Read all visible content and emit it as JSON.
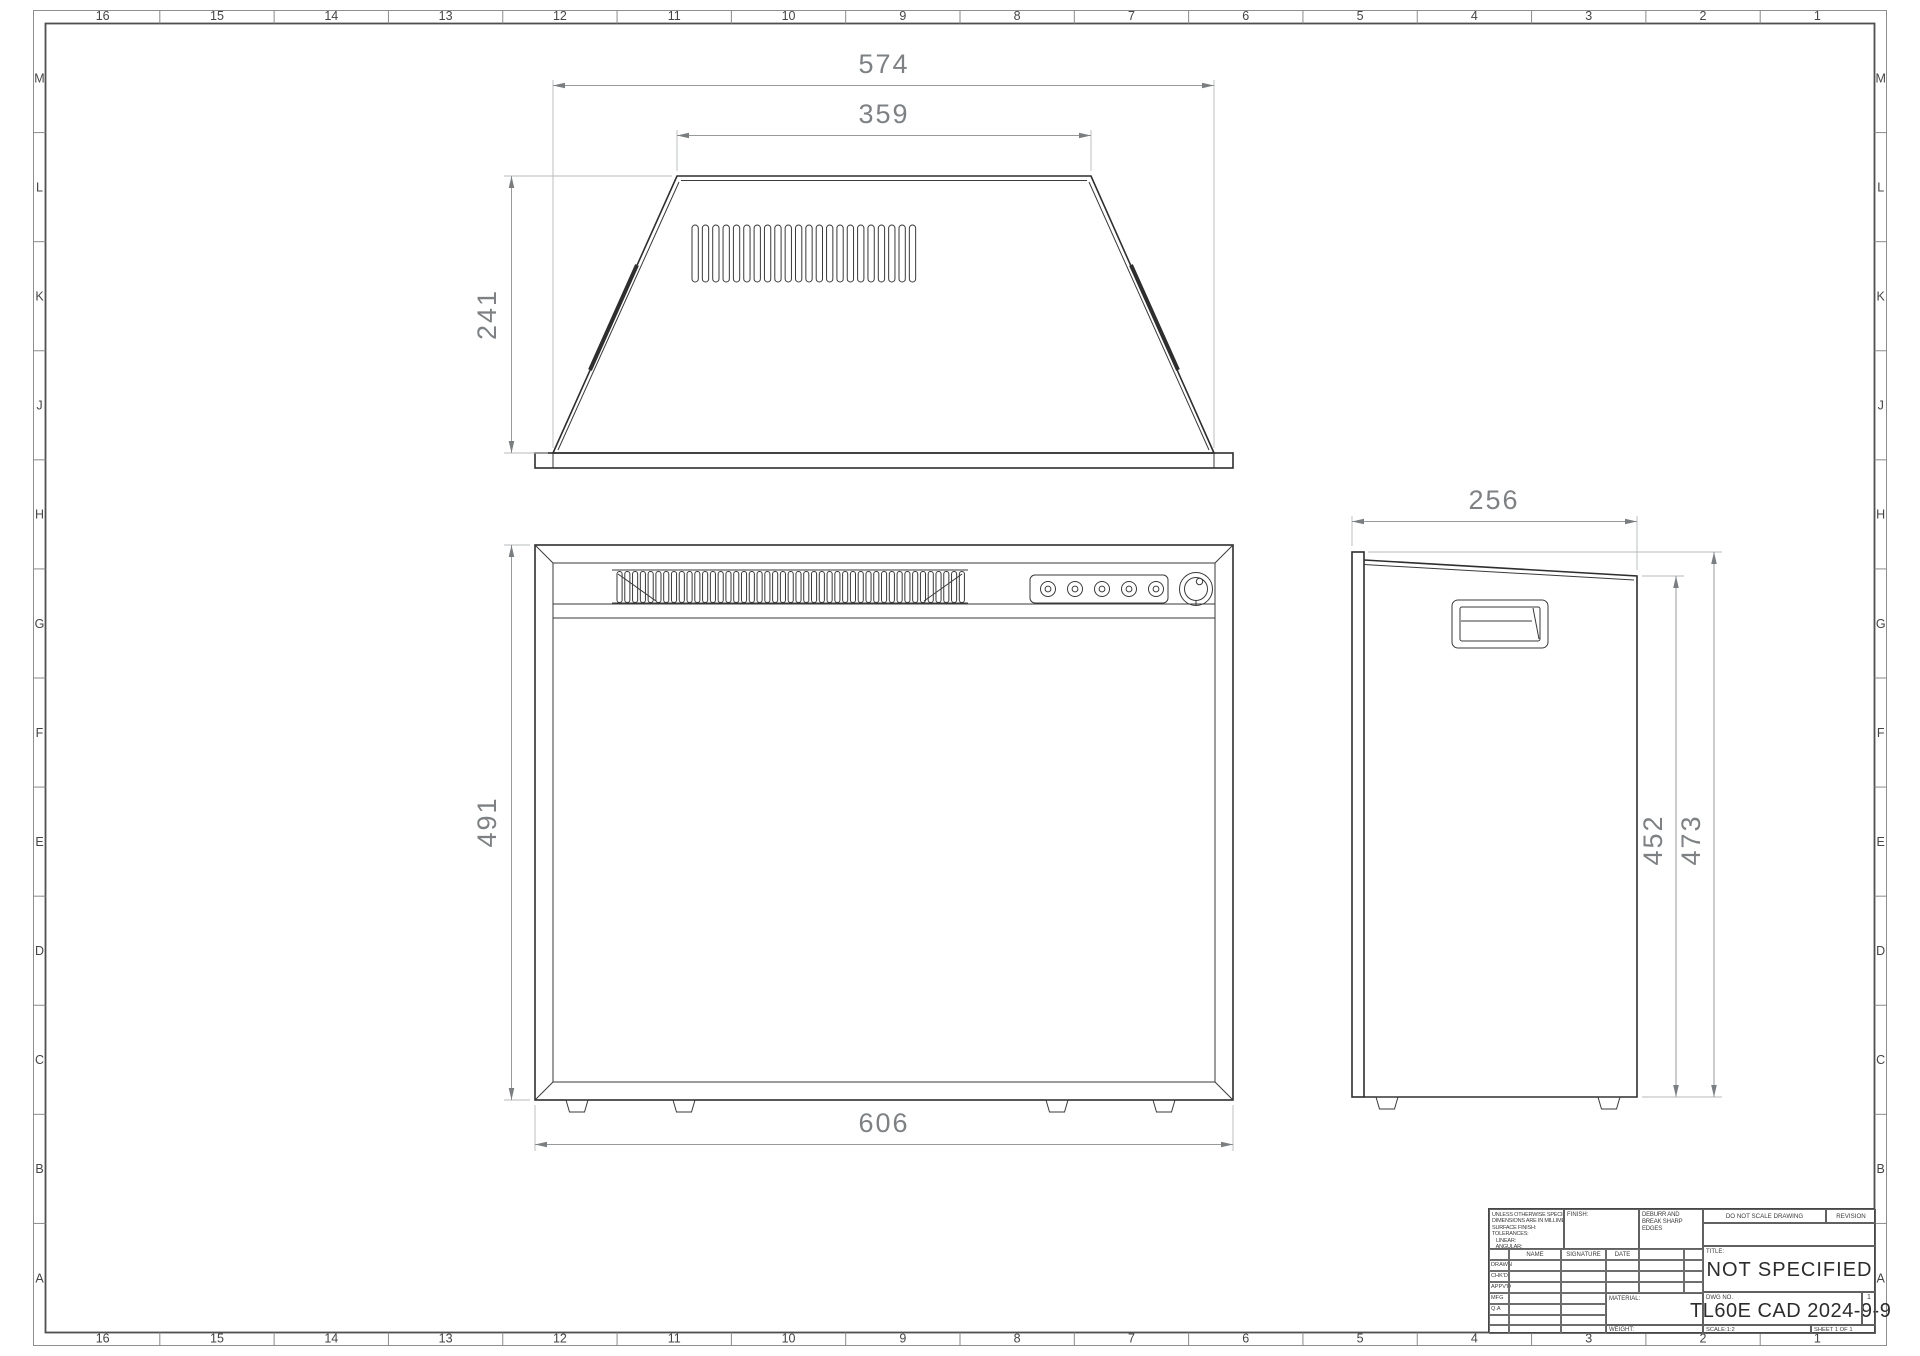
{
  "sheet": {
    "zone_columns": [
      "16",
      "15",
      "14",
      "13",
      "12",
      "11",
      "10",
      "9",
      "8",
      "7",
      "6",
      "5",
      "4",
      "3",
      "2",
      "1"
    ],
    "zone_rows": [
      "M",
      "L",
      "K",
      "J",
      "H",
      "G",
      "F",
      "E",
      "D",
      "C",
      "B",
      "A"
    ]
  },
  "views": {
    "top": {
      "width_bottom": "574",
      "width_top": "359",
      "depth": "241",
      "slot_count": 22
    },
    "front": {
      "width": "606",
      "height": "491",
      "slat_count": 45,
      "button_count": 5
    },
    "side": {
      "depth": "256",
      "height_back": "452",
      "height_overall": "473"
    }
  },
  "title_block": {
    "tolerance_note": "UNLESS OTHERWISE SPECIFIED:\nDIMENSIONS ARE IN MILLIMETERS\nSURFACE FINISH:\nTOLERANCES:\n   LINEAR:\n   ANGULAR:",
    "finish_label": "FINISH:",
    "deburr_note": "DEBURR AND\nBREAK SHARP\nEDGES",
    "do_not_scale": "DO NOT SCALE DRAWING",
    "revision_label": "REVISION",
    "name_header": "NAME",
    "signature_header": "SIGNATURE",
    "date_header": "DATE",
    "approval_rows": [
      "DRAWN",
      "CHK'D",
      "APPV'D",
      "MFG",
      "Q.A"
    ],
    "title_label": "TITLE:",
    "title_value": "NOT SPECIFIED",
    "dwg_label": "DWG NO.",
    "dwg_value": "TL60E CAD 2024-9-9",
    "size_note": "1",
    "material_label": "MATERIAL:",
    "weight_label": "WEIGHT:",
    "scale_label": "SCALE:1:2",
    "sheet_label": "SHEET 1 OF 1"
  }
}
